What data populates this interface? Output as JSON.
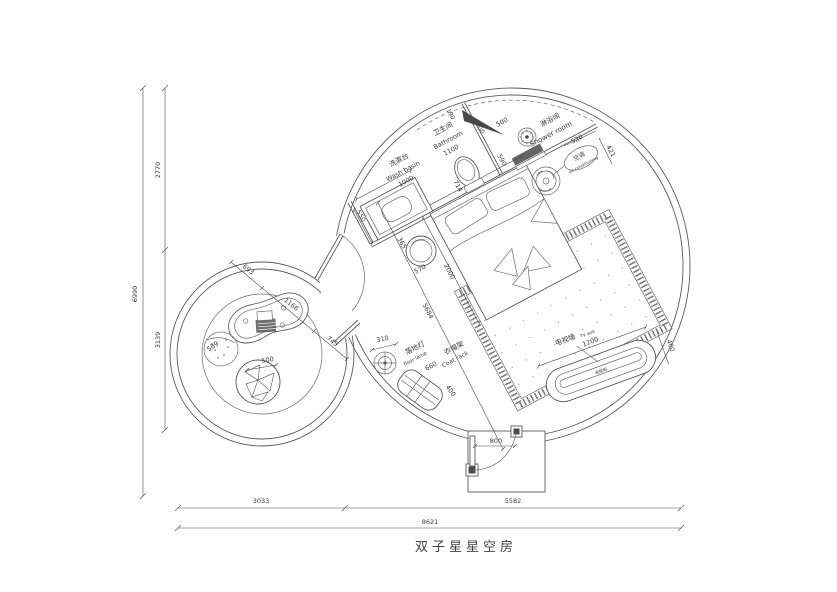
{
  "title": "双子星星空房",
  "colors": {
    "line": "#5a5a5a",
    "background": "#ffffff",
    "text": "#3a3a3a"
  },
  "labels": {
    "wash_basin_cn": "洗漱台",
    "wash_basin_en": "Wash basin",
    "bathroom_cn": "卫生间",
    "bathroom_en": "Bathroom",
    "shower_cn": "淋浴间",
    "shower_en": "Shower room",
    "ac_cn": "空调",
    "ac_en": "air-conditioning",
    "lamp_cn": "落地灯",
    "lamp_en": "floor lamp",
    "coat_cn": "衣帽架",
    "coat_en": "Coat rack",
    "tv_cn": "电视墙",
    "tv_en": "TV wall",
    "tv_cab_cn": "电视柜"
  },
  "dims": {
    "overall_w": "8621",
    "bottom_left": "3033",
    "bottom_right": "5582",
    "overall_h": "6990",
    "left_top": "2770",
    "left_bottom": "3139",
    "basin_w": "1000",
    "basin_d": "550",
    "bath_w": "1100",
    "bath_gap": "190",
    "toilet_w": "700",
    "toilet_d": "714",
    "shower_door": "500",
    "shower_d": "590",
    "ac_w": "520",
    "ac_d": "421",
    "bed_w": "1800",
    "bed_l": "2000",
    "nightstand_a": "365",
    "nightstand_b": "570",
    "diag": "5684",
    "lamp_d": "310",
    "coat_w": "660",
    "coat_d": "400",
    "tv_w": "1200",
    "tv_d": "400",
    "table_a": "693",
    "table_b": "1166",
    "table_c": "745",
    "pouf_d": "589",
    "beanbag_d": "500",
    "door_w": "800"
  }
}
